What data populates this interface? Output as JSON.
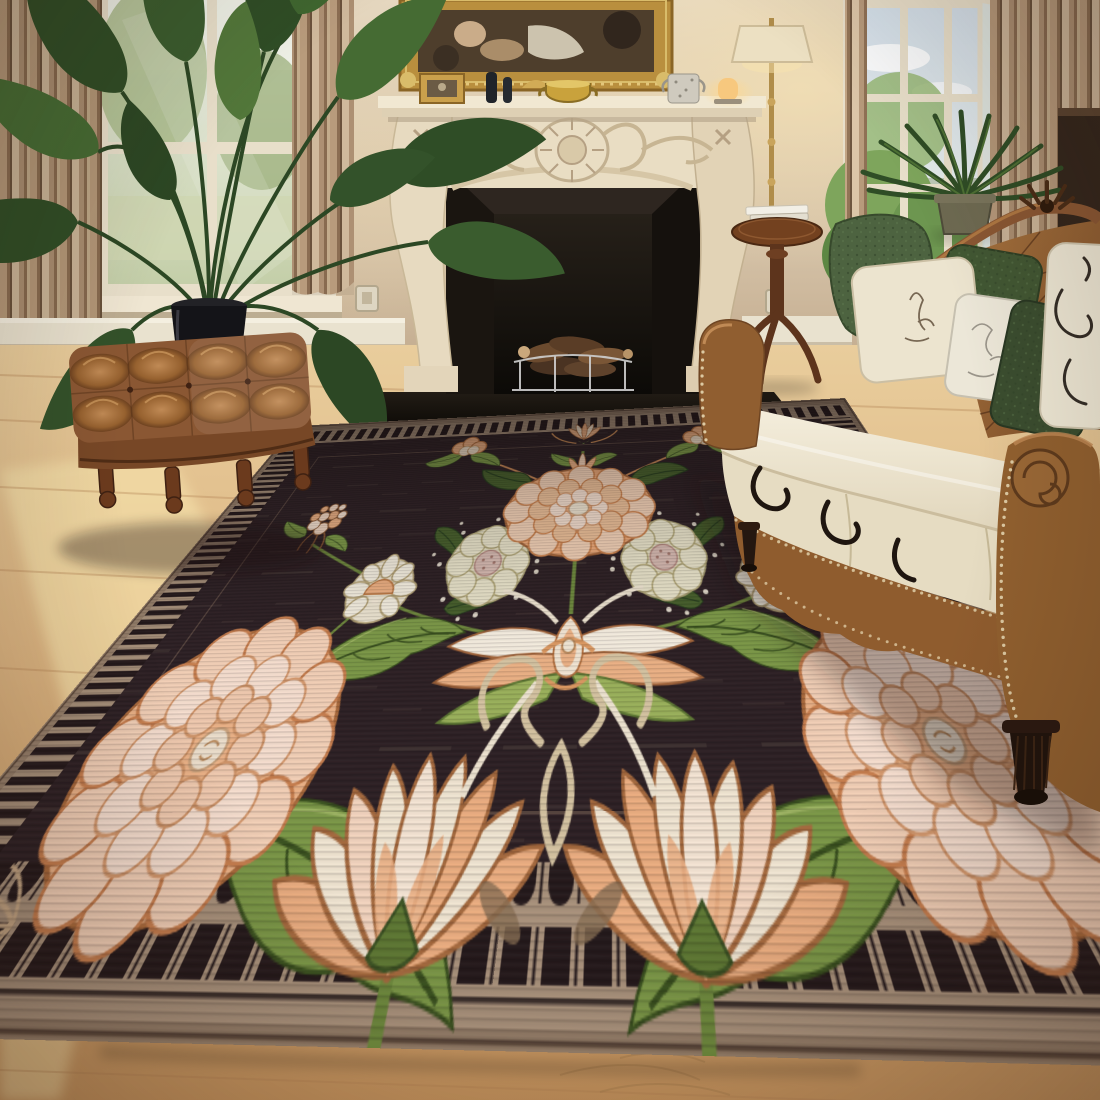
{
  "image": {
    "type": "interior product photograph",
    "subject": "dark floral area rug styled in a classic living room",
    "width_px": 1100,
    "height_px": 1100,
    "visible_text": "none"
  },
  "room": {
    "wall_color": "#d8c7af",
    "floor": "light oak hardwood with warm sun patches",
    "lighting": "soft daylight from left and right windows, warm glow near floor lamp and candle",
    "objects": [
      {
        "name": "gilt-framed classical painting",
        "location": "top center above mantel",
        "colors": [
          "#b98f3e",
          "#4e3e2c"
        ]
      },
      {
        "name": "ornate carved cream fireplace mantel",
        "location": "center background",
        "colors": [
          "#e9ddc3",
          "#c2b090"
        ]
      },
      {
        "name": "black marble firebox with stacked firewood and grate",
        "location": "center",
        "colors": [
          "#1a1510",
          "#6b4a2e"
        ]
      },
      {
        "name": "mantel decor: gilt photo frame, two dark bottles, brass pot, speckled tumbler, lit candle lamp",
        "location": "on mantel shelf"
      },
      {
        "name": "tall leafy houseplant in black cylinder pot",
        "location": "left, before the window"
      },
      {
        "name": "pleated beige striped curtains",
        "location": "flanking both windows"
      },
      {
        "name": "window with soft garden view",
        "location": "upper left"
      },
      {
        "name": "open window with trees, hills and sky",
        "location": "upper right"
      },
      {
        "name": "potted fern",
        "location": "right window sill area"
      },
      {
        "name": "brass floor lamp with cream shade",
        "location": "right of fireplace"
      },
      {
        "name": "round mahogany pedestal side table with white books",
        "location": "right of fireplace"
      },
      {
        "name": "tufted brown leather ottoman on turned legs",
        "location": "lower left on wood floor"
      },
      {
        "name": "brown leather chesterfield sofa, cream seat cushions, green and cream pillows, nailhead trim, carved crest",
        "location": "right foreground"
      },
      {
        "name": "two small wall outlets",
        "location": "flanking the fireplace"
      },
      {
        "name": "white floor vent box",
        "location": "left of fireplace at baseboard"
      }
    ]
  },
  "rug": {
    "style": "Art Nouveau / William Morris style symmetric floral",
    "field_color": "#2d2125",
    "border": {
      "description": "tan border with dark piano-key fringe teeth, brick-dash top band and fine comb stripes on the sides",
      "tan": "#a8927c",
      "dark_teeth": "#241a1c"
    },
    "motifs": [
      {
        "name": "top crest lotus bud",
        "position": "top center"
      },
      {
        "name": "large peach chrysanthemum bloom",
        "position": "upper center"
      },
      {
        "name": "pair of pale cream daisies with rose centers",
        "position": "center, flanking stem"
      },
      {
        "name": "wide white-and-peach lotus flower",
        "position": "center"
      },
      {
        "name": "cream scroll ornament with loop",
        "position": "below center lotus"
      },
      {
        "name": "two large blush peony rosettes",
        "position": "left and right"
      },
      {
        "name": "two large cream-peach fan carnations",
        "position": "bottom center, overlapping border"
      },
      {
        "name": "berry and blossom clusters",
        "position": "upper left and right"
      },
      {
        "name": "small cream side daisies with peach centers",
        "position": "mid left and right"
      },
      {
        "name": "large olive acanthus leaves and vines",
        "position": "throughout"
      },
      {
        "name": "scattered white dots",
        "position": "around daisies"
      },
      {
        "name": "tan grass sprigs",
        "position": "bottom corners"
      }
    ],
    "palette": {
      "peach": "#eeb487",
      "dark_peach": "#dd9a62",
      "blush": "#f6d8c2",
      "cream": "#f3ead8",
      "white": "#f8f2e6",
      "olive_green": "#7c9a48",
      "light_olive": "#9cb45c",
      "dark_green": "#46602c",
      "outline_brown": "#8a5a36"
    }
  },
  "furniture_palette": {
    "leather_brown": "#8f5c2e",
    "leather_highlight": "#c08a55",
    "cushion_cream": "#f1ebd9",
    "pillow_green": "#4d6340",
    "wood_dark": "#5d341c",
    "brass": "#b08d4a"
  }
}
